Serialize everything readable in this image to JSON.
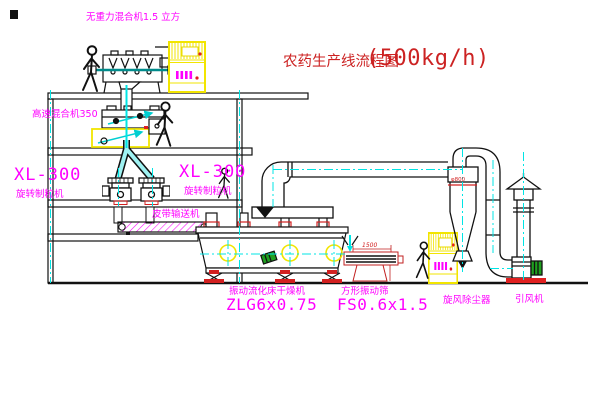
{
  "drawing": {
    "title": {
      "name": "农药生产线流程图",
      "capacity": "(500kg/h)"
    },
    "equipment_labels": {
      "gravity_mixer": "无重力混合机1.5 立方",
      "high_speed_mixer": "高速混合机350",
      "granulator_left": {
        "model": "XL-300",
        "name": "旋转制粒机"
      },
      "granulator_right": {
        "model": "XL-300",
        "name": "旋转制粒机"
      },
      "belt_conveyor": "皮带输送机",
      "fluid_bed_dryer": {
        "name": "振动流化床干燥机",
        "model": "ZLG6x0.75"
      },
      "vibrating_sieve": {
        "name": "方形振动筛",
        "model": "FS0.6x1.5",
        "dimension": "1500"
      },
      "cyclone": {
        "name": "旋风除尘器",
        "dimension": "φ800"
      },
      "induced_draft_fan": "引风机"
    },
    "colors": {
      "label_magenta": "#ff00ff",
      "title_red": "#cc2222",
      "pipe_cyan": "#00e5e5",
      "cabinet_yellow": "#f2e500",
      "motor_green": "#1fa01f",
      "sieve_red": "#d22020",
      "line_black": "#111111"
    }
  }
}
